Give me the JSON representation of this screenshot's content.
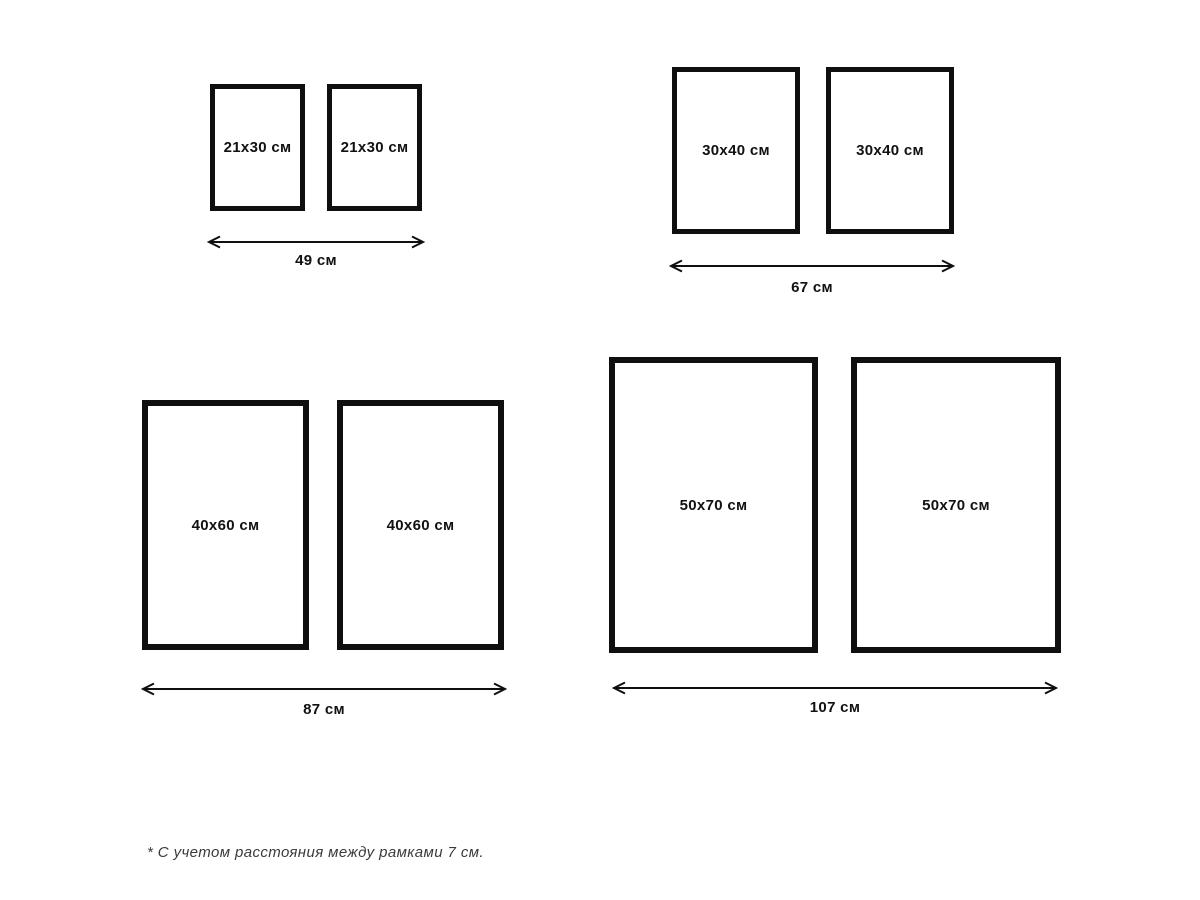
{
  "groups": [
    {
      "frames": [
        "21x30 см",
        "21x30 см"
      ],
      "total_width": "49 см"
    },
    {
      "frames": [
        "30x40 см",
        "30x40 см"
      ],
      "total_width": "67 см"
    },
    {
      "frames": [
        "40x60 см",
        "40x60 см"
      ],
      "total_width": "87 см"
    },
    {
      "frames": [
        "50x70 см",
        "50x70 см"
      ],
      "total_width": "107 см"
    }
  ],
  "footnote": "* С учетом расстояния между рамками 7 см.",
  "colors": {
    "background": "#ffffff",
    "frame_border": "#0f0f0f",
    "label_text": "#111111",
    "footnote_text": "#3a3a3a"
  }
}
